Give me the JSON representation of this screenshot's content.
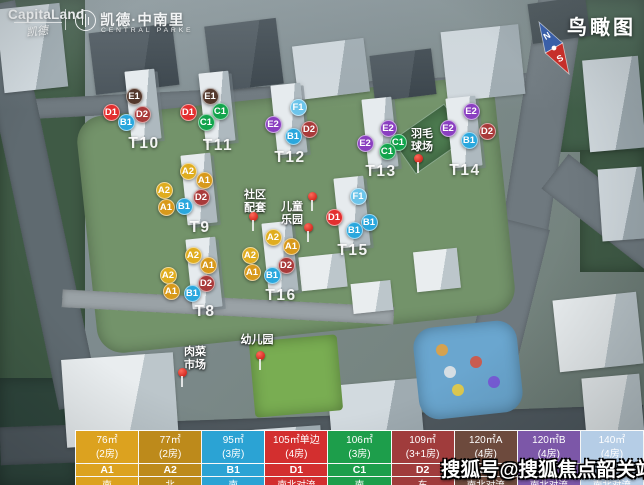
{
  "header": {
    "capitaland": "CapitaLand",
    "capitaland_script": "凯德",
    "project_name": "凯德·中南里",
    "project_subtitle": "CENTRAL PARKE",
    "view_label": "鸟瞰图",
    "compass": {
      "north": "N",
      "south": "S"
    }
  },
  "watermark": "搜狐号@搜狐焦点韶关站",
  "badge_colors": {
    "A1": "#d8991b",
    "A2": "#e0ad1f",
    "B1": "#2aa7dd",
    "C1": "#12a44c",
    "D1": "#e32f2f",
    "D2": "#a93a3a",
    "E1": "#53382c",
    "E2": "#8a3fc0",
    "F1": "#6cc4ea"
  },
  "towers": [
    {
      "label": "T10",
      "x": 144,
      "y": 144,
      "badges": [
        {
          "code": "E1",
          "x": 134,
          "y": 96
        },
        {
          "code": "D1",
          "x": 111,
          "y": 112
        },
        {
          "code": "D2",
          "x": 142,
          "y": 114
        },
        {
          "code": "B1",
          "x": 126,
          "y": 122
        }
      ]
    },
    {
      "label": "T11",
      "x": 218,
      "y": 146,
      "badges": [
        {
          "code": "E1",
          "x": 210,
          "y": 96
        },
        {
          "code": "D1",
          "x": 188,
          "y": 112
        },
        {
          "code": "C1",
          "x": 220,
          "y": 111
        },
        {
          "code": "C1",
          "x": 206,
          "y": 122
        }
      ]
    },
    {
      "label": "T12",
      "x": 290,
      "y": 158,
      "badges": [
        {
          "code": "F1",
          "x": 298,
          "y": 107
        },
        {
          "code": "E2",
          "x": 273,
          "y": 124
        },
        {
          "code": "D2",
          "x": 309,
          "y": 129
        },
        {
          "code": "B1",
          "x": 293,
          "y": 136
        }
      ]
    },
    {
      "label": "T13",
      "x": 381,
      "y": 172,
      "badges": [
        {
          "code": "E2",
          "x": 388,
          "y": 128
        },
        {
          "code": "E2",
          "x": 365,
          "y": 143
        },
        {
          "code": "C1",
          "x": 398,
          "y": 142
        },
        {
          "code": "C1",
          "x": 387,
          "y": 151
        }
      ]
    },
    {
      "label": "T14",
      "x": 465,
      "y": 171,
      "badges": [
        {
          "code": "E2",
          "x": 471,
          "y": 111
        },
        {
          "code": "E2",
          "x": 448,
          "y": 128
        },
        {
          "code": "D2",
          "x": 487,
          "y": 131
        },
        {
          "code": "B1",
          "x": 469,
          "y": 140
        }
      ]
    },
    {
      "label": "T9",
      "x": 200,
      "y": 228,
      "badges": [
        {
          "code": "A2",
          "x": 188,
          "y": 171
        },
        {
          "code": "A1",
          "x": 204,
          "y": 180
        },
        {
          "code": "A2",
          "x": 164,
          "y": 190
        },
        {
          "code": "D2",
          "x": 201,
          "y": 197
        },
        {
          "code": "A1",
          "x": 166,
          "y": 207
        },
        {
          "code": "B1",
          "x": 184,
          "y": 206
        }
      ]
    },
    {
      "label": "T15",
      "x": 353,
      "y": 251,
      "badges": [
        {
          "code": "F1",
          "x": 358,
          "y": 196
        },
        {
          "code": "D1",
          "x": 334,
          "y": 217
        },
        {
          "code": "B1",
          "x": 369,
          "y": 222
        },
        {
          "code": "B1",
          "x": 354,
          "y": 230
        }
      ]
    },
    {
      "label": "T16",
      "x": 281,
      "y": 296,
      "badges": [
        {
          "code": "A2",
          "x": 273,
          "y": 237
        },
        {
          "code": "A1",
          "x": 291,
          "y": 246
        },
        {
          "code": "A2",
          "x": 250,
          "y": 255
        },
        {
          "code": "D2",
          "x": 286,
          "y": 265
        },
        {
          "code": "A1",
          "x": 252,
          "y": 272
        },
        {
          "code": "B1",
          "x": 272,
          "y": 275
        }
      ]
    },
    {
      "label": "T8",
      "x": 205,
      "y": 312,
      "badges": [
        {
          "code": "A2",
          "x": 193,
          "y": 255
        },
        {
          "code": "A1",
          "x": 208,
          "y": 265
        },
        {
          "code": "A2",
          "x": 168,
          "y": 275
        },
        {
          "code": "D2",
          "x": 206,
          "y": 283
        },
        {
          "code": "A1",
          "x": 171,
          "y": 291
        },
        {
          "code": "B1",
          "x": 192,
          "y": 293
        }
      ]
    }
  ],
  "facilities": [
    {
      "name": "社区配套",
      "lines": [
        "社区",
        "配套"
      ],
      "x": 255,
      "y": 189
    },
    {
      "name": "儿童乐园",
      "lines": [
        "儿童",
        "乐园"
      ],
      "x": 292,
      "y": 201
    },
    {
      "name": "羽毛球场",
      "lines": [
        "羽毛",
        "球场"
      ],
      "x": 422,
      "y": 128
    },
    {
      "name": "幼儿园",
      "lines": [
        "幼儿园"
      ],
      "x": 257,
      "y": 334
    },
    {
      "name": "肉菜市场",
      "lines": [
        "肉菜",
        "市场"
      ],
      "x": 195,
      "y": 346
    }
  ],
  "pins": [
    {
      "x": 418,
      "y": 158
    },
    {
      "x": 312,
      "y": 196
    },
    {
      "x": 308,
      "y": 227
    },
    {
      "x": 253,
      "y": 216
    },
    {
      "x": 260,
      "y": 355
    },
    {
      "x": 182,
      "y": 372
    }
  ],
  "legend": {
    "columns": [
      {
        "area": "76㎡",
        "rooms": "(2房)",
        "unit": "A1",
        "orientation": "南",
        "color": "#dca21f"
      },
      {
        "area": "77㎡",
        "rooms": "(2房)",
        "unit": "A2",
        "orientation": "北",
        "color": "#bd8a1b"
      },
      {
        "area": "95㎡",
        "rooms": "(3房)",
        "unit": "B1",
        "orientation": "南",
        "color": "#2ba3d4"
      },
      {
        "area": "105㎡单边",
        "rooms": "(4房)",
        "unit": "D1",
        "orientation": "南北对流",
        "color": "#d32f2f"
      },
      {
        "area": "106㎡",
        "rooms": "(3房)",
        "unit": "C1",
        "orientation": "南",
        "color": "#1d9e4b"
      },
      {
        "area": "109㎡",
        "rooms": "(3+1房)",
        "unit": "D2",
        "orientation": "东",
        "color": "#a03c3c"
      },
      {
        "area": "120㎡A",
        "rooms": "(4房)",
        "unit": "E1",
        "orientation": "南北对流",
        "color": "#6d4a3d"
      },
      {
        "area": "120㎡B",
        "rooms": "(4房)",
        "unit": "E2",
        "orientation": "南北对流",
        "color": "#7c57a8"
      },
      {
        "area": "140㎡",
        "rooms": "(4房)",
        "unit": "F1",
        "orientation": "南北对流",
        "color": "#b5cde6"
      }
    ]
  }
}
